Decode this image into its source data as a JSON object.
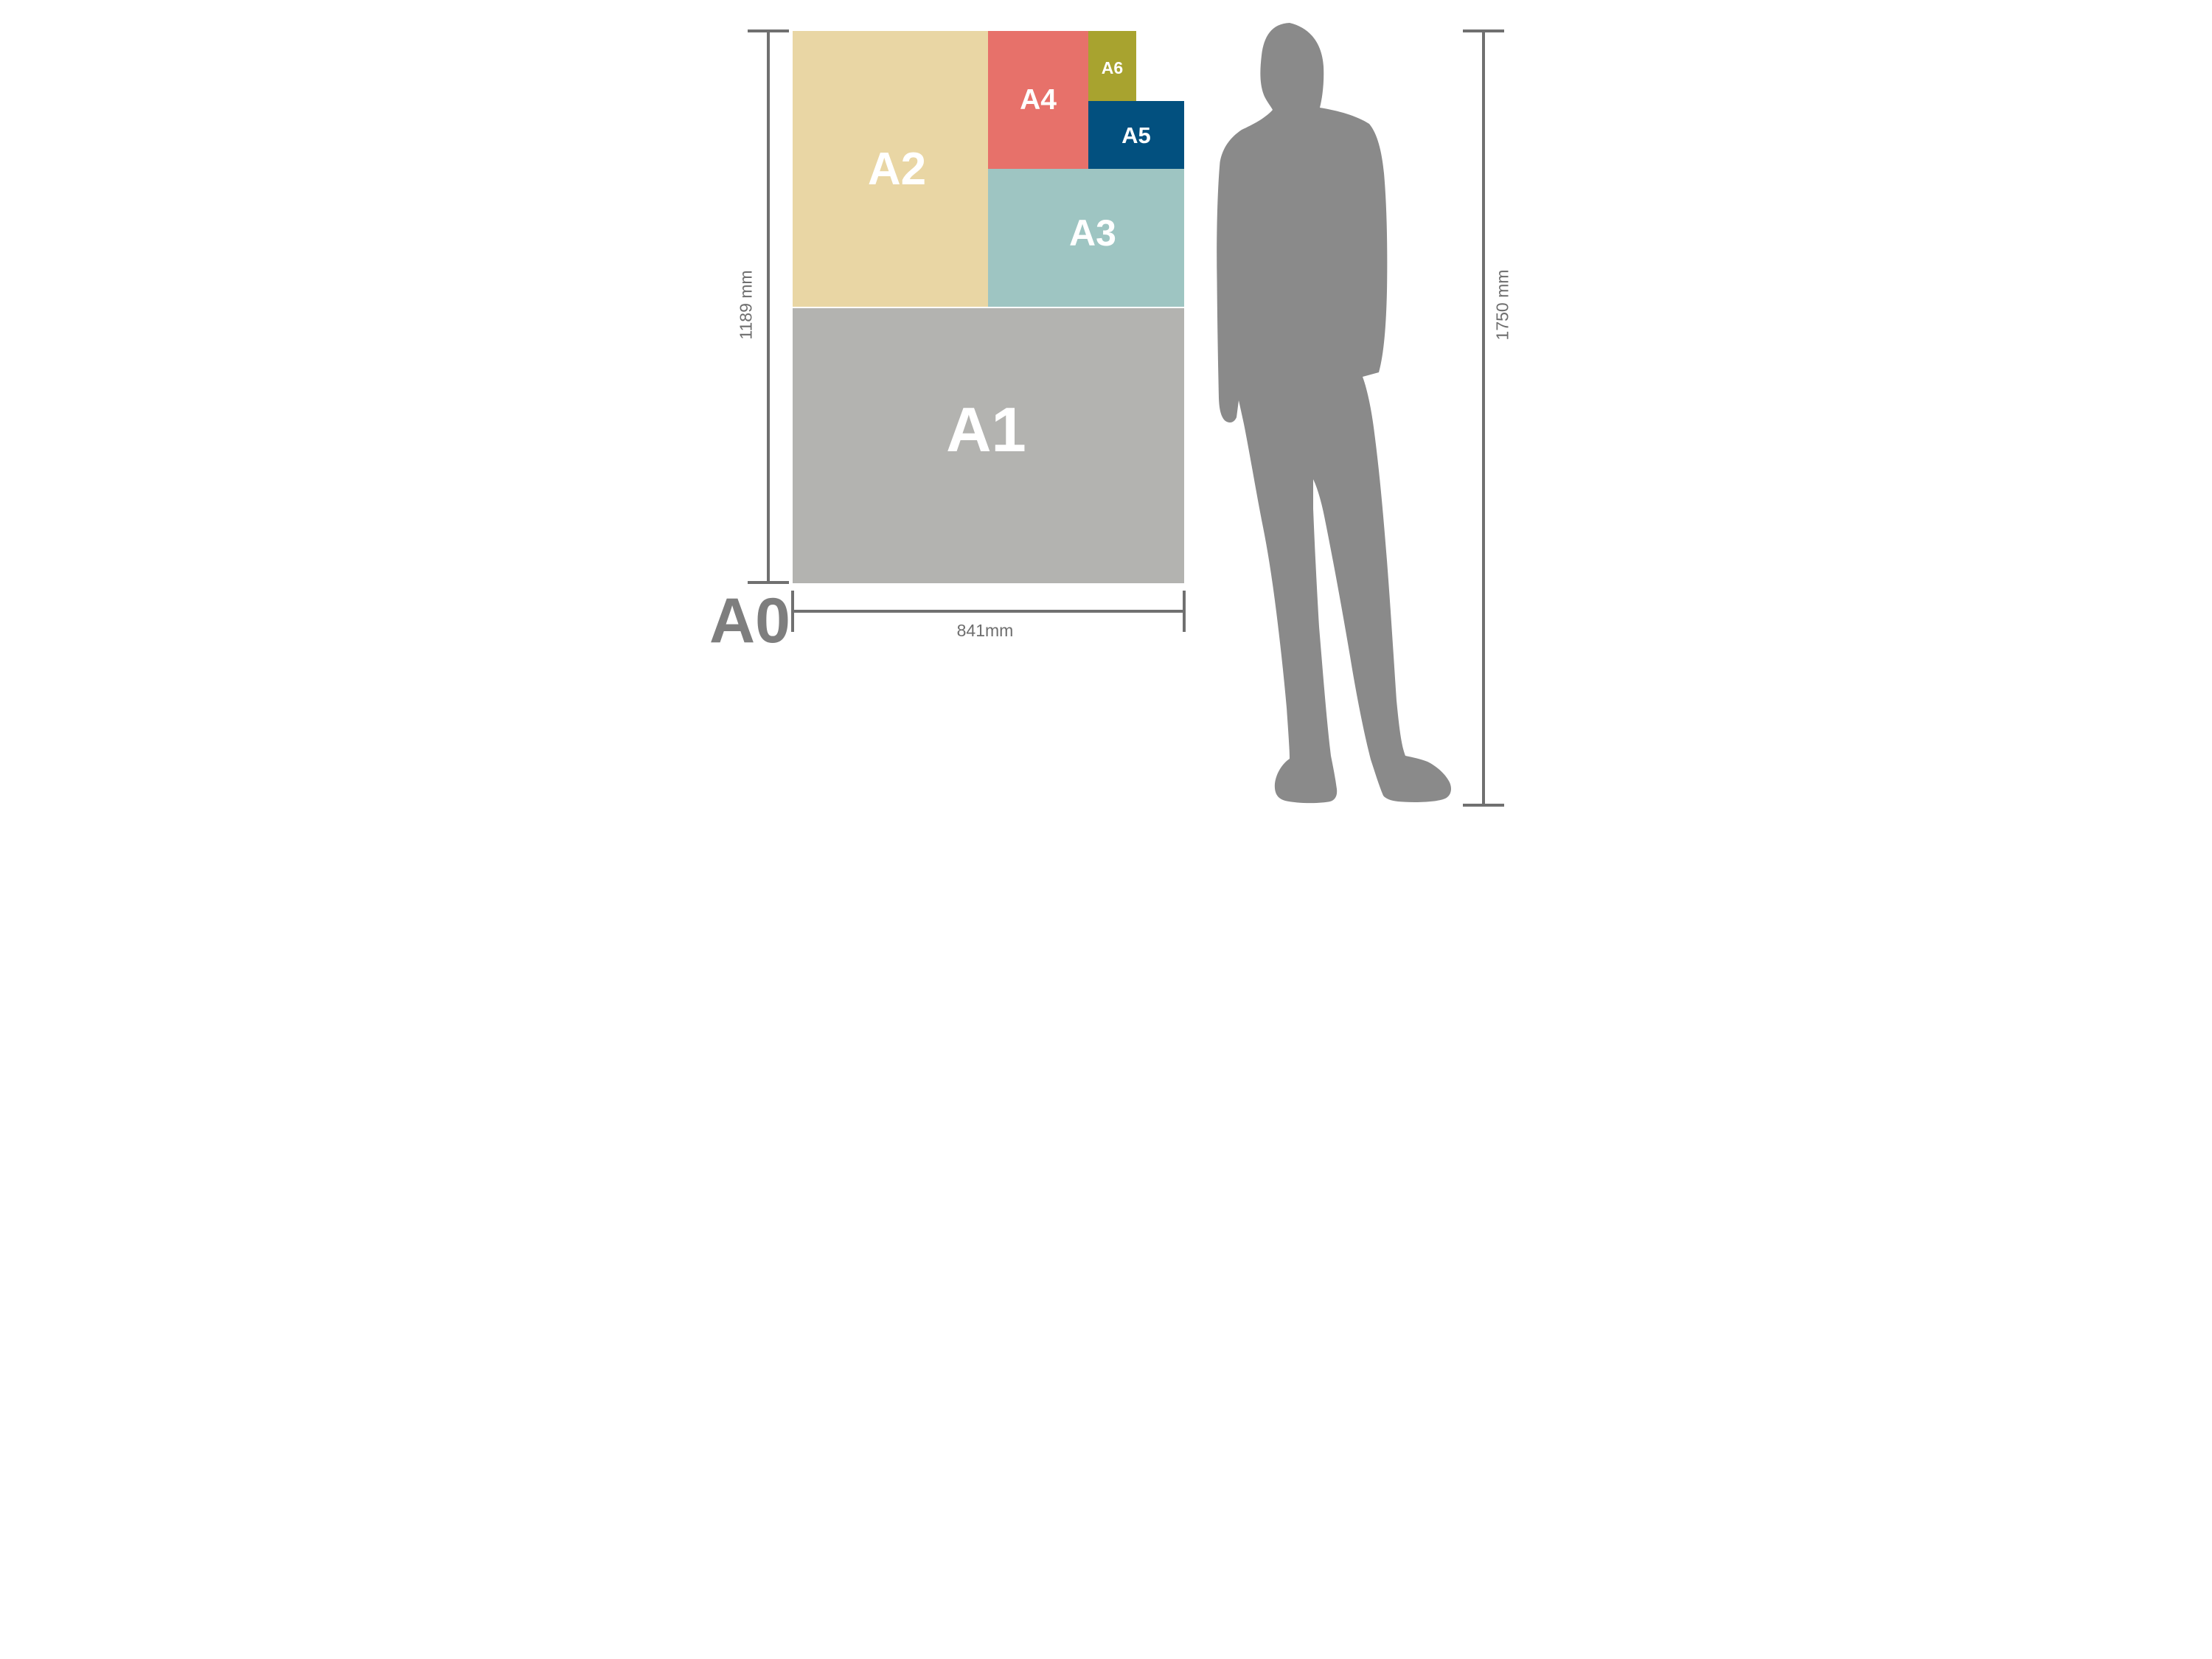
{
  "sheets": {
    "a1": {
      "label": "A1",
      "color": "#b3b3b0"
    },
    "a2": {
      "label": "A2",
      "color": "#e9d6a4"
    },
    "a3": {
      "label": "A3",
      "color": "#9ec5c2"
    },
    "a4": {
      "label": "A4",
      "color": "#e7716a"
    },
    "a5": {
      "label": "A5",
      "color": "#02507f"
    },
    "a6": {
      "label": "A6",
      "color": "#a8a32f"
    }
  },
  "dimensions": {
    "base_size_label": "A0",
    "sheet_height_label": "1189 mm",
    "sheet_width_label": "841mm",
    "person_height_label": "1750 mm"
  },
  "colors": {
    "background": "#ffffff",
    "sheet_label_text": "#ffffff",
    "person_silhouette": "#8a8a8a",
    "dimension_line": "#707070",
    "dimension_text": "#6e6e6e",
    "a0_text": "#7e7e7e"
  }
}
